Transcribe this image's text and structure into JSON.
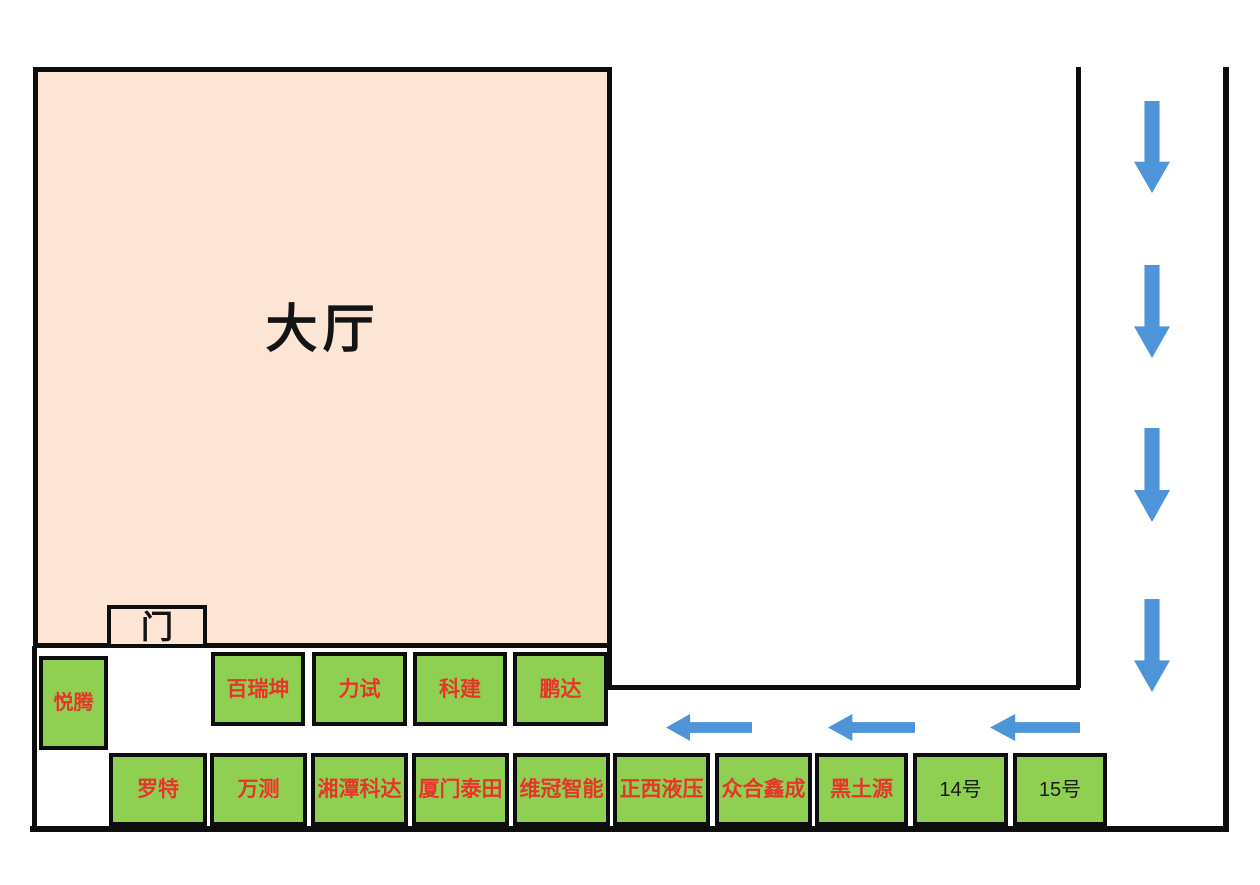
{
  "hall": {
    "label": "大厅"
  },
  "door": {
    "label": "门"
  },
  "booths": {
    "side": "悦腾",
    "row1": [
      "百瑞坤",
      "力试",
      "科建",
      "鹏达"
    ],
    "row2": [
      "罗特",
      "万测",
      "湘潭科达",
      "厦门泰田",
      "维冠智能",
      "正西液压",
      "众合鑫成",
      "黑土源"
    ],
    "row2_numbered": [
      "14号",
      "15号"
    ]
  },
  "icons": {
    "down_arrow": "down-arrow",
    "left_arrow": "left-arrow",
    "down_arrow_count": 4,
    "left_arrow_count": 3
  },
  "colors": {
    "hall_fill": "#FCE5D5",
    "booth_fill": "#8FD052",
    "booth_text_red": "#E6362A",
    "numbered_text": "#1A1A1A",
    "arrow_blue": "#4E94D8",
    "wall": "#0D0D0D"
  }
}
